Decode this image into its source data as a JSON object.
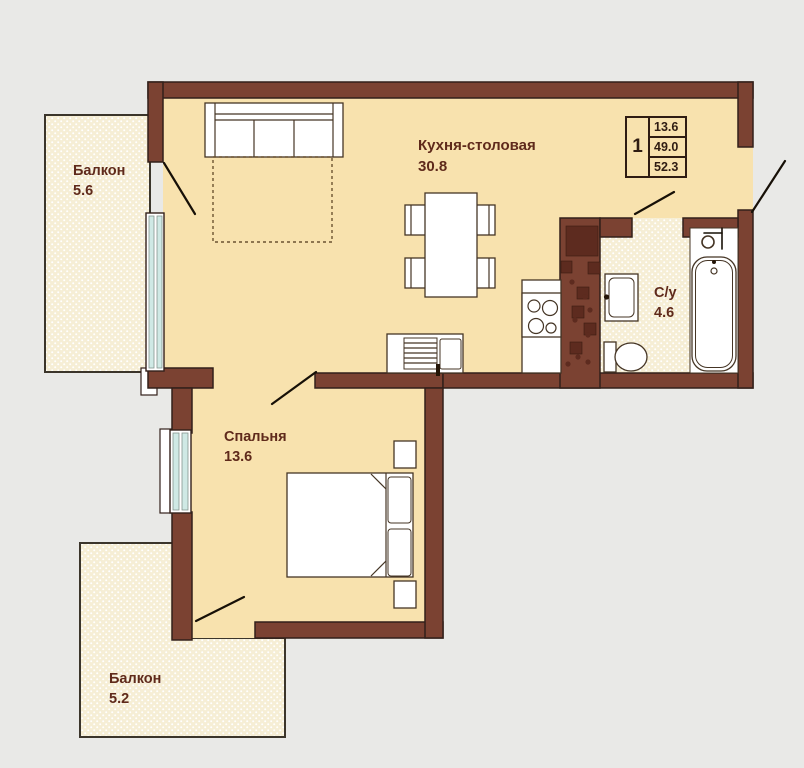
{
  "legend": {
    "rooms_count": "1",
    "living_area": "13.6",
    "apartment_area": "49.0",
    "total_area": "52.3"
  },
  "rooms": {
    "kitchen_dining": {
      "name": "Кухня-столовая",
      "area": "30.8"
    },
    "bedroom": {
      "name": "Спальня",
      "area": "13.6"
    },
    "bathroom": {
      "name": "С/у",
      "area": "4.6"
    },
    "balcony_top": {
      "name": "Балкон",
      "area": "5.6"
    },
    "balcony_bottom": {
      "name": "Балкон",
      "area": "5.2"
    }
  },
  "colors": {
    "bg": "#e9e9e7",
    "floor": "#f8e2ae",
    "wall": "#7b4232",
    "wall_line": "#33201a",
    "balcony_floor": "#f6eed5",
    "glass": "#cfe9e5",
    "text": "#5f2a1b",
    "door_line": "#171007",
    "shaft_decor": "#5d2b1f"
  }
}
